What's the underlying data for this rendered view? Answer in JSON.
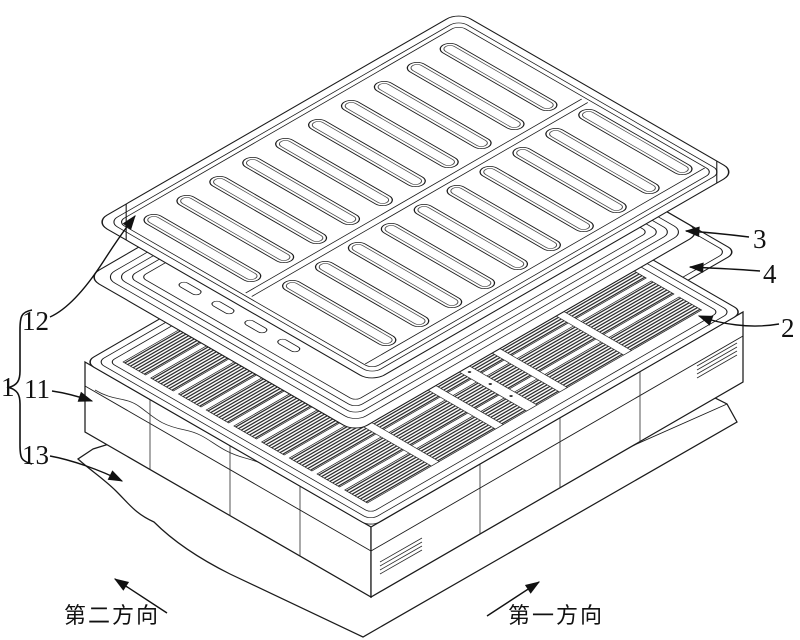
{
  "figure_labels": {
    "n1": "1",
    "n2": "2",
    "n3": "3",
    "n4": "4",
    "n11": "11",
    "n12": "12",
    "n13": "13"
  },
  "direction_labels": {
    "second_direction": "第二方向",
    "first_direction": "第一方向"
  },
  "style_colors": {
    "line": "#1b1b1b",
    "background": "#ffffff",
    "cell_hatch": "#2e2e2e"
  }
}
